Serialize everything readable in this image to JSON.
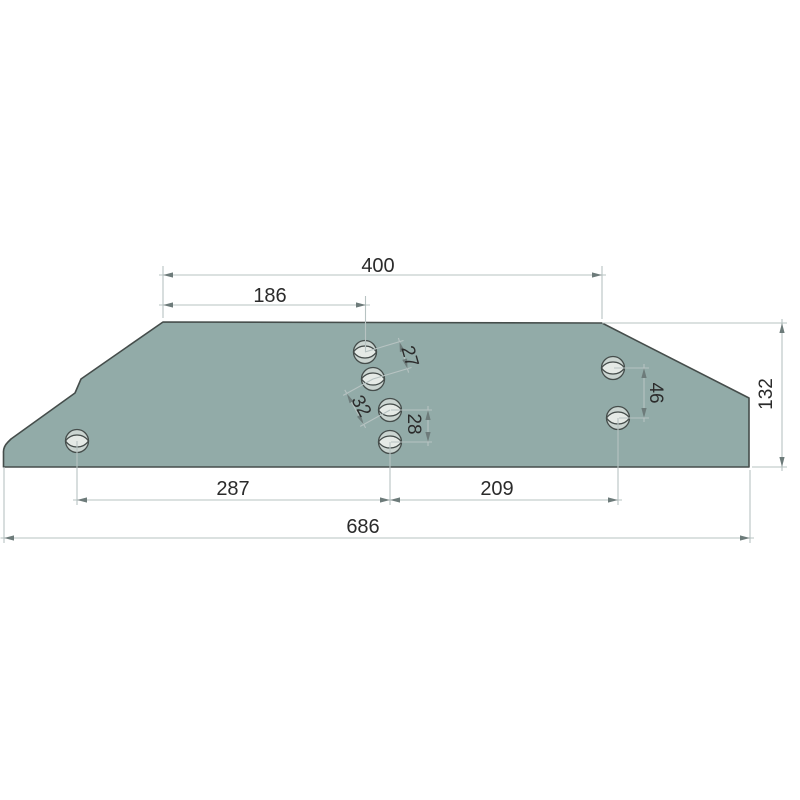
{
  "colors": {
    "background": "#ffffff",
    "plate_fill": "#92aba8",
    "plate_stroke": "#454d4b",
    "dim_line": "#b7c3c2",
    "arrow": "#6d7b7a",
    "dim_text": "#2b2b2b",
    "hole_fill": "#cbd5d1",
    "hole_lens_fill": "#e5eae6"
  },
  "dimensions": {
    "top_overall": {
      "label": "400"
    },
    "top_left_to_first_hole": {
      "label": "186"
    },
    "hole_pitch_upper": {
      "label": "27"
    },
    "hole_pitch_middle": {
      "label": "32"
    },
    "hole_pitch_lower": {
      "label": "28"
    },
    "right_hole_pitch": {
      "label": "46"
    },
    "plate_height": {
      "label": "132"
    },
    "bottom_left_span": {
      "label": "287"
    },
    "bottom_right_span": {
      "label": "209"
    },
    "bottom_overall": {
      "label": "686"
    }
  },
  "holes": {
    "count": 7,
    "style": "countersunk-plow-bolt-hole"
  }
}
